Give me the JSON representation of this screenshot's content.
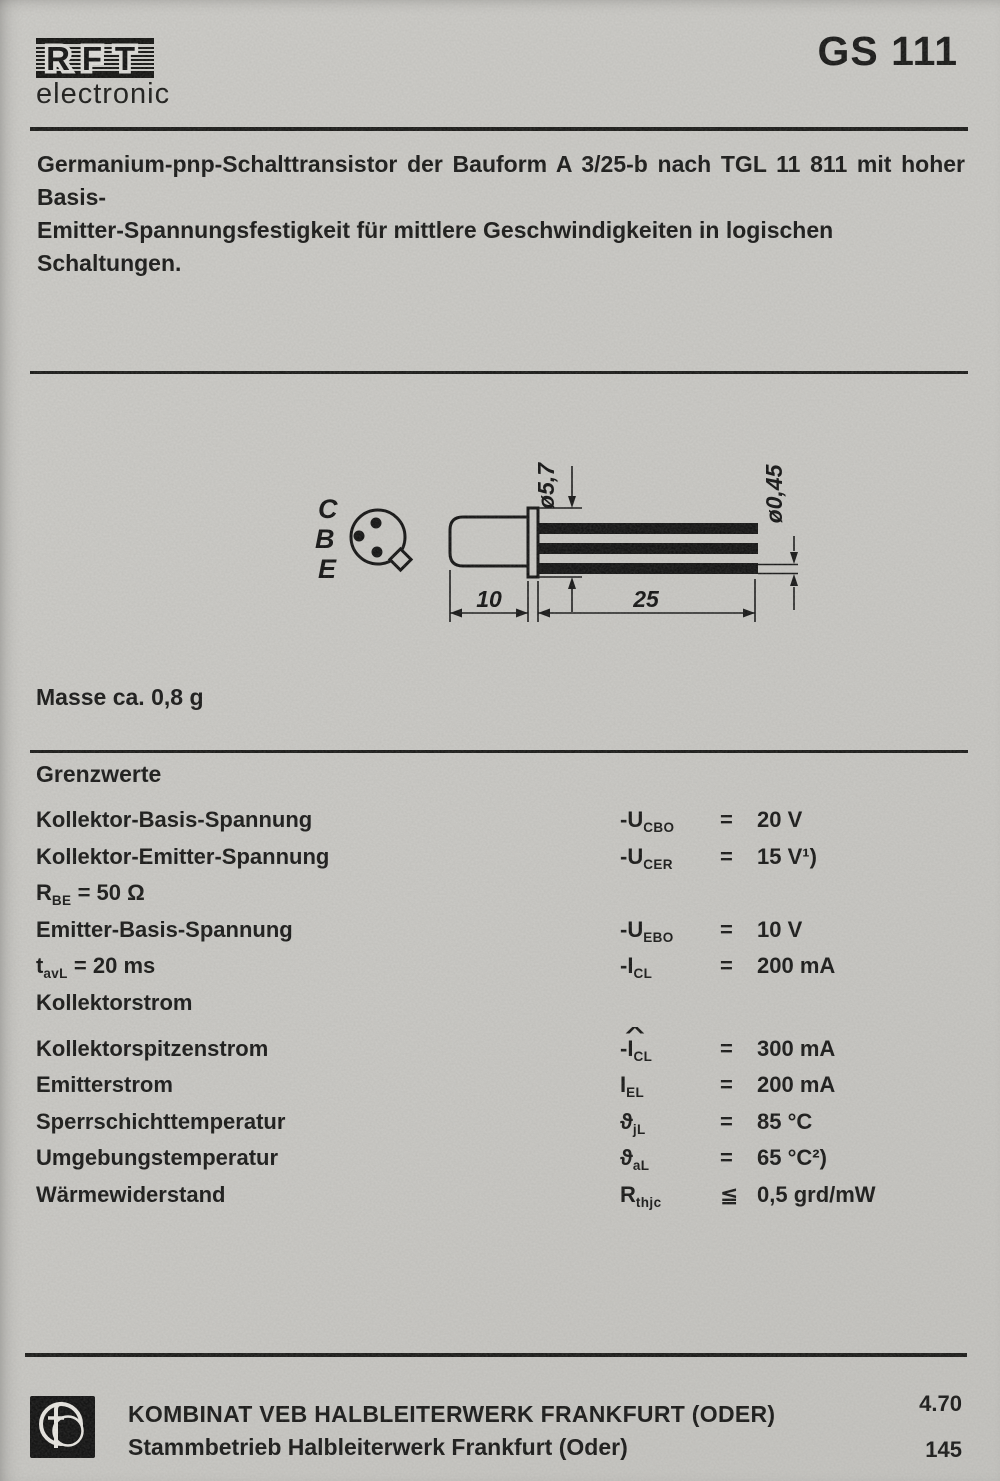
{
  "header": {
    "brand": {
      "letters": [
        "R",
        "F",
        "T"
      ],
      "sub": "electronic"
    },
    "title": "GS 111"
  },
  "intro": {
    "line1": "Germanium-pnp-Schalttransistor der Bauform A 3/25-b nach TGL 11 811 mit hoher Basis-",
    "line2": "Emitter-Spannungsfestigkeit für mittlere Geschwindigkeiten in logischen Schaltungen."
  },
  "drawing": {
    "pins": [
      "C",
      "B",
      "E"
    ],
    "dims": {
      "flange_diameter": "ø5,7",
      "lead_diameter": "ø0,45",
      "body_length": "10",
      "lead_length": "25"
    }
  },
  "mass_note": "Masse ca. 0,8 g",
  "limits": {
    "heading": "Grenzwerte",
    "rows": [
      {
        "label_main": "Kollektor-Basis-Spannung",
        "label_sub": "",
        "label_rest": "",
        "sym_hat": "",
        "sym_pre": "-U",
        "sym_sub": "CBO",
        "eq": "=",
        "value": "20 V"
      },
      {
        "label_main": "Kollektor-Emitter-Spannung",
        "label_sub": "",
        "label_rest": "",
        "sym_hat": "",
        "sym_pre": "-U",
        "sym_sub": "CER",
        "eq": "=",
        "value": "15 V¹)"
      },
      {
        "label_main": "R",
        "label_sub": "BE",
        "label_rest": " = 50 Ω",
        "sym_hat": "",
        "sym_pre": "",
        "sym_sub": "",
        "eq": "",
        "value": ""
      },
      {
        "label_main": "Emitter-Basis-Spannung",
        "label_sub": "",
        "label_rest": "",
        "sym_hat": "",
        "sym_pre": "-U",
        "sym_sub": "EBO",
        "eq": "=",
        "value": "10 V"
      },
      {
        "label_main": "t",
        "label_sub": "avL",
        "label_rest": " = 20 ms",
        "sym_hat": "",
        "sym_pre": "-I",
        "sym_sub": "CL",
        "eq": "=",
        "value": "200 mA"
      },
      {
        "label_main": "Kollektorstrom",
        "label_sub": "",
        "label_rest": "",
        "sym_hat": "",
        "sym_pre": "",
        "sym_sub": "",
        "eq": "",
        "value": ""
      },
      {
        "label_main": "Kollektorspitzenstrom",
        "label_sub": "",
        "label_rest": "",
        "sym_hat": "^",
        "sym_pre": "-I",
        "sym_sub": "CL",
        "eq": "=",
        "value": "300 mA"
      },
      {
        "label_main": "Emitterstrom",
        "label_sub": "",
        "label_rest": "",
        "sym_hat": "",
        "sym_pre": "I",
        "sym_sub": "EL",
        "eq": "=",
        "value": "200 mA"
      },
      {
        "label_main": "Sperrschichttemperatur",
        "label_sub": "",
        "label_rest": "",
        "sym_hat": "",
        "sym_pre": "ϑ",
        "sym_sub": "jL",
        "eq": "=",
        "value": "85 °C"
      },
      {
        "label_main": "Umgebungstemperatur",
        "label_sub": "",
        "label_rest": "",
        "sym_hat": "",
        "sym_pre": "ϑ",
        "sym_sub": "aL",
        "eq": "=",
        "value": "65 °C²)"
      },
      {
        "label_main": "Wärmewiderstand",
        "label_sub": "",
        "label_rest": "",
        "sym_hat": "",
        "sym_pre": "R",
        "sym_sub": "thjc",
        "eq": "≦",
        "value": "0,5 grd/mW"
      }
    ]
  },
  "footer": {
    "line1": "KOMBINAT VEB HALBLEITERWERK FRANKFURT (ODER)",
    "line2": "Stammbetrieb Halbleiterwerk Frankfurt (Oder)",
    "issue": "4.70",
    "page_number": "145"
  }
}
